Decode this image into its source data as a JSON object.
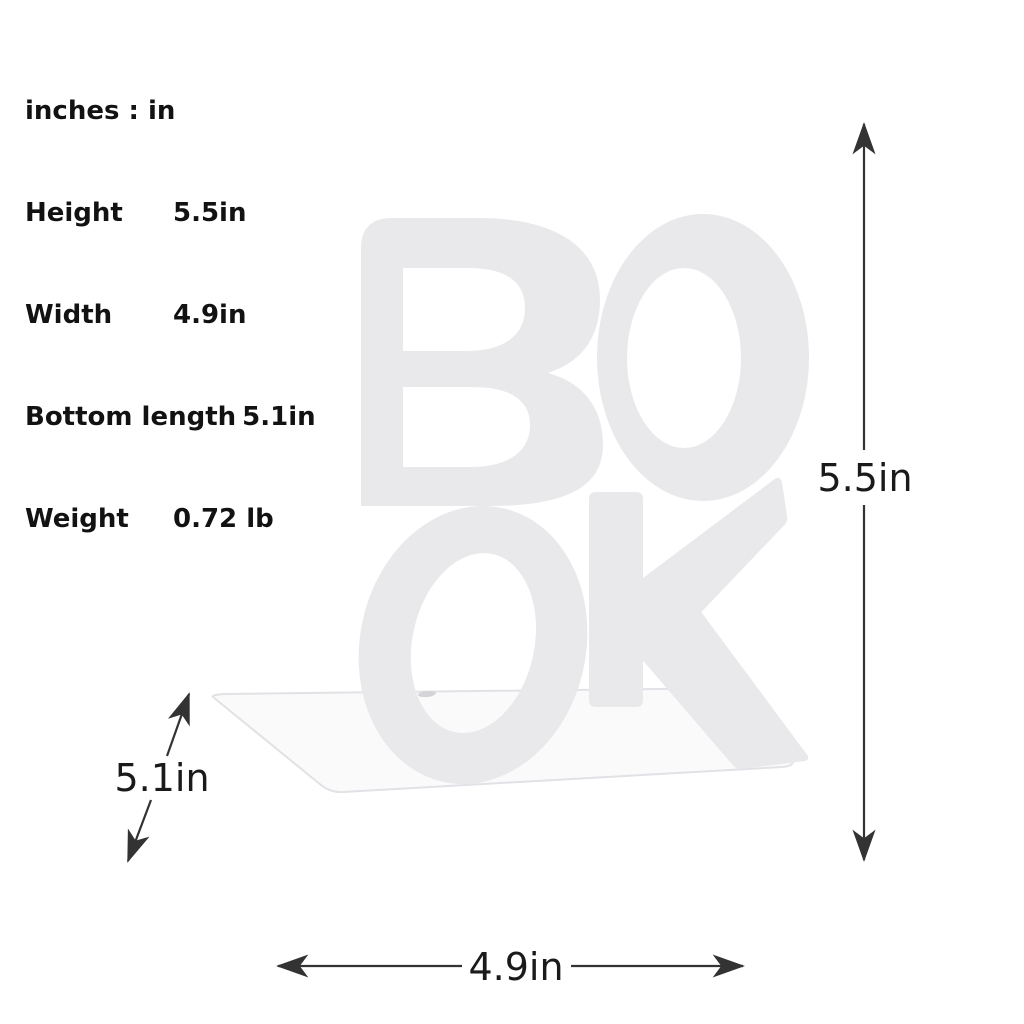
{
  "specs": {
    "unit_note": "inches : in",
    "rows": [
      {
        "label": "Height",
        "value": "5.5in"
      },
      {
        "label": "Width",
        "value": "4.9in"
      },
      {
        "label": "Bottom length",
        "value": "5.1in"
      },
      {
        "label": "Weight",
        "value": "0.72 lb"
      }
    ]
  },
  "dimensions": {
    "height": "5.5in",
    "width": "4.9in",
    "bottom_length": "5.1in"
  },
  "product": {
    "type": "metal bookend",
    "letters": "BOOK",
    "letter_color": "#e9e9eb",
    "base_color": "#fafafb",
    "base_edge_color": "#e2e2e6",
    "background_color": "#ffffff",
    "annotation_color": "#1a1a1a"
  }
}
